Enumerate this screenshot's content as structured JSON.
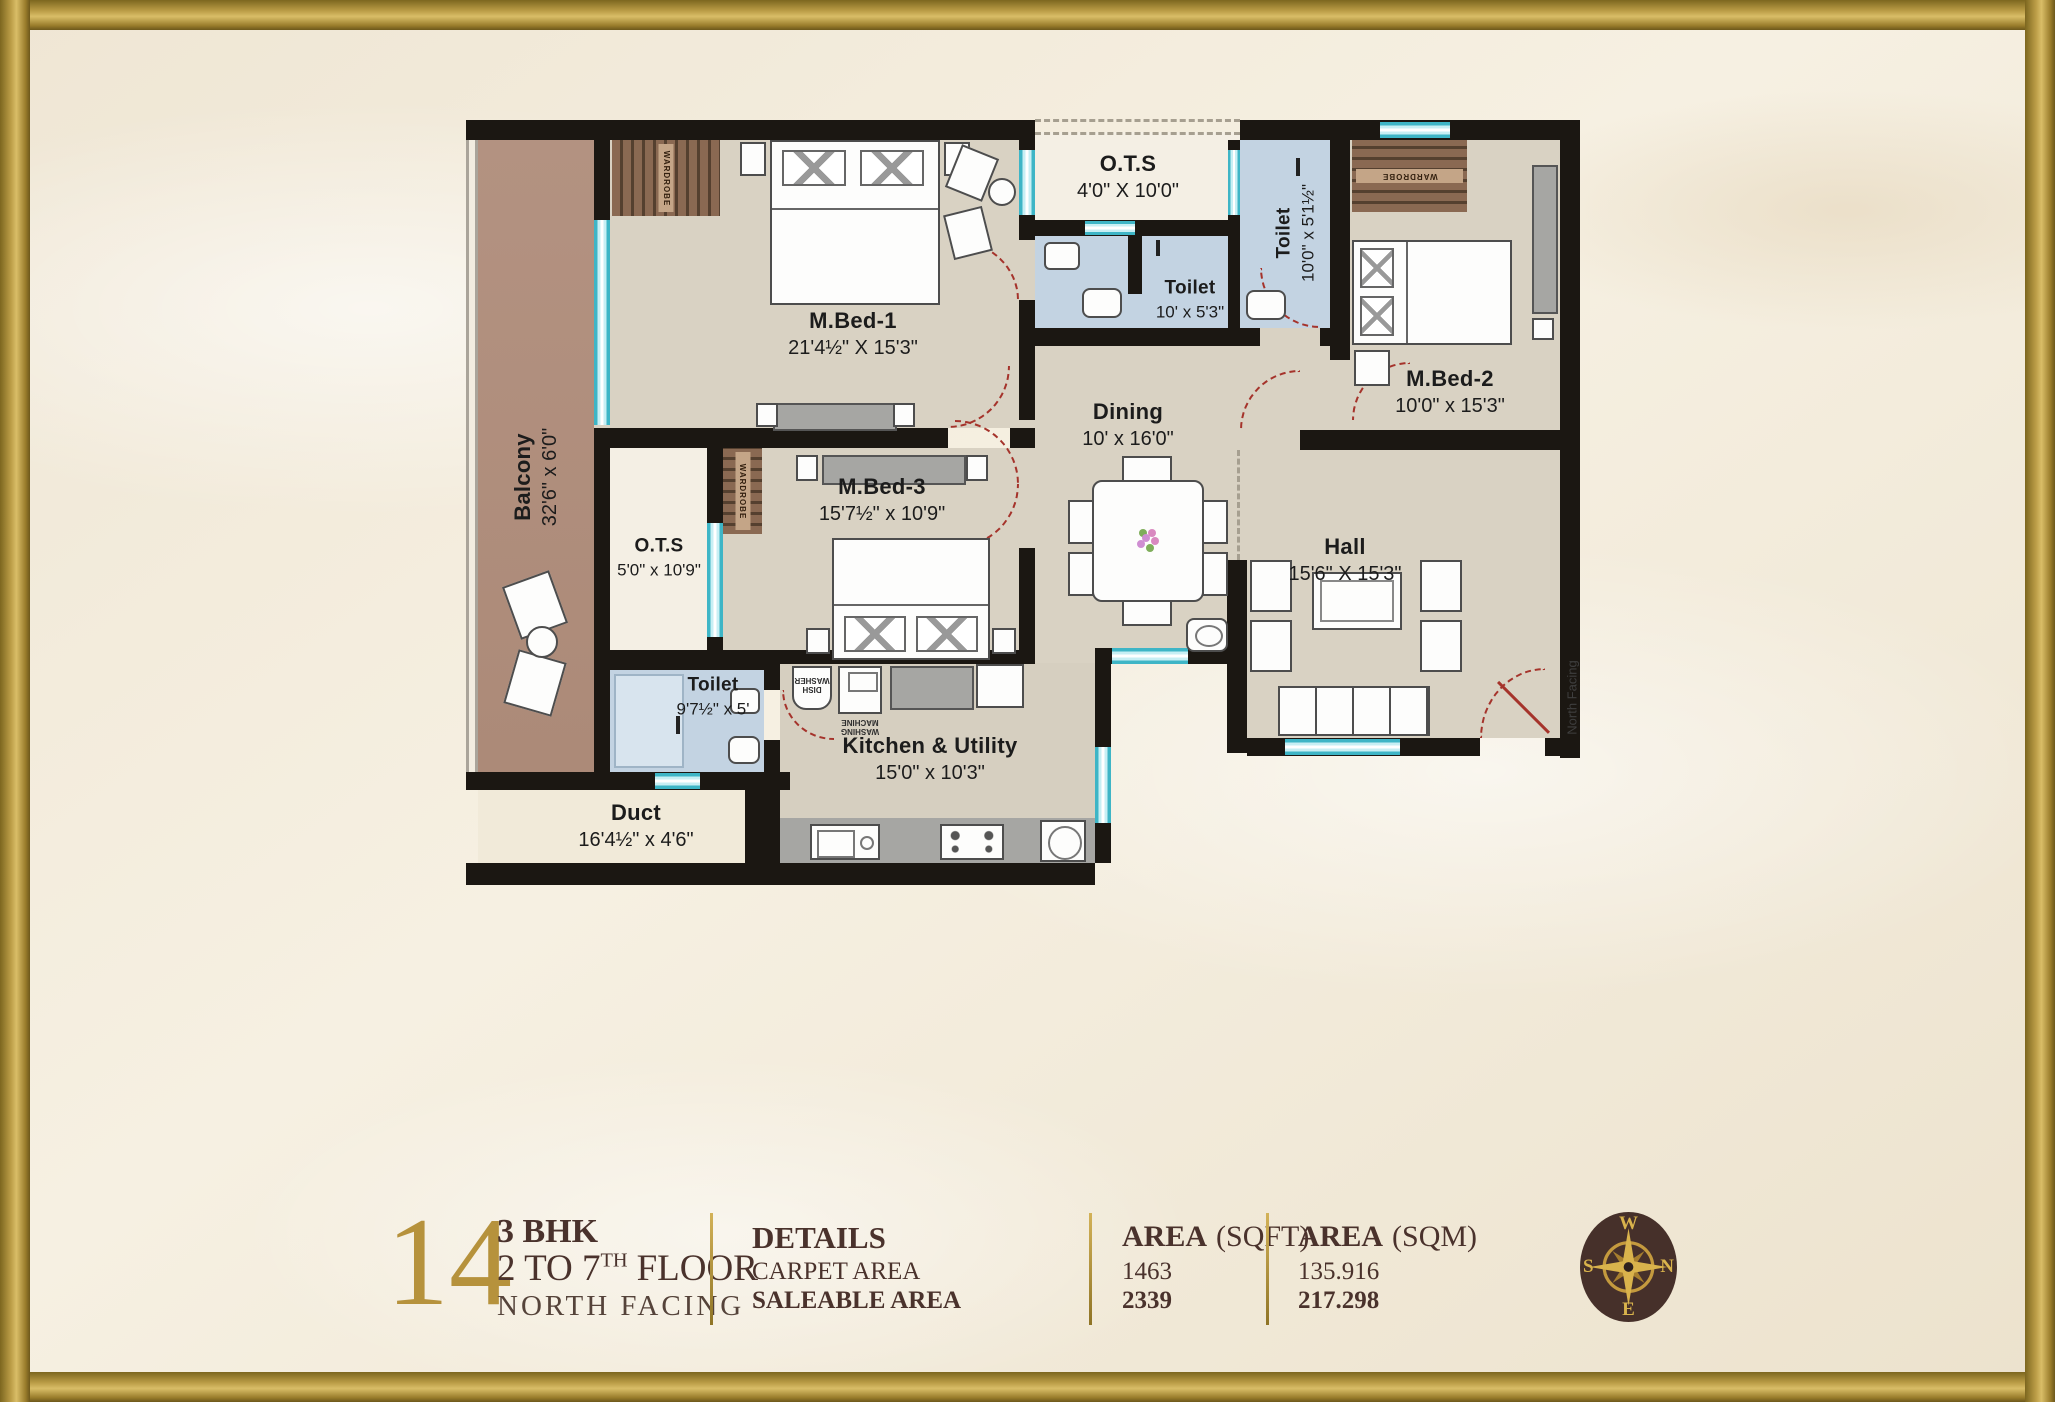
{
  "plan": {
    "rooms": {
      "balcony": {
        "name": "Balcony",
        "dim": "32'6\" x 6'0\""
      },
      "mbed1": {
        "name": "M.Bed-1",
        "dim": "21'4½\" X 15'3\""
      },
      "ots_top": {
        "name": "O.T.S",
        "dim": "4'0\" X 10'0\""
      },
      "toilet_top": {
        "name": "Toilet",
        "dim": "10' x 5'3\""
      },
      "toilet_right": {
        "name": "Toilet",
        "dim": "10'0\" x 5'1½\""
      },
      "mbed2": {
        "name": "M.Bed-2",
        "dim": "10'0\" x 15'3\""
      },
      "dining": {
        "name": "Dining",
        "dim": "10' x 16'0\""
      },
      "mbed3": {
        "name": "M.Bed-3",
        "dim": "15'7½\" x 10'9\""
      },
      "ots_left": {
        "name": "O.T.S",
        "dim": "5'0\" x 10'9\""
      },
      "toilet_bottom": {
        "name": "Toilet",
        "dim": "9'7½\" x 5'"
      },
      "kitchen": {
        "name": "Kitchen & Utility",
        "dim": "15'0\" x 10'3\""
      },
      "duct": {
        "name": "Duct",
        "dim": "16'4½\" x 4'6\""
      },
      "hall": {
        "name": "Hall",
        "dim": "15'6\" X 15'3\""
      }
    },
    "annotations": {
      "wardrobe": "WARDROBE",
      "washing_machine": "WASHING\nMACHINE",
      "dish_washer": "DISH\nWASHER",
      "north_facing": "North Facing"
    }
  },
  "info_bar": {
    "unit_number": "14",
    "unit_type": "3 BHK",
    "floor_prefix": "2 TO 7",
    "floor_sup": "TH",
    "floor_suffix": "FLOOR",
    "facing": "NORTH FACING",
    "details_title": "DETAILS",
    "carpet_label": "CARPET AREA",
    "saleable_label": "SALEABLE AREA",
    "sqft_title": "AREA",
    "sqft_unit": "(SQFT)",
    "sqft_carpet": "1463",
    "sqft_saleable": "2339",
    "sqm_title": "AREA",
    "sqm_unit": "(SQM)",
    "sqm_carpet": "135.916",
    "sqm_saleable": "217.298"
  },
  "compass": {
    "top": "W",
    "right": "N",
    "bottom": "E",
    "left": "S"
  },
  "colors": {
    "gold": "#b6923c",
    "wall": "#1b1712",
    "window_cyan": "#54c3d4",
    "door_red": "#a5332b",
    "toilet_blue": "#c3d3e2",
    "balcony_brown": "#b19080",
    "room_taupe": "#d9d2c3",
    "ots_white": "#f4efe4",
    "text_brown": "#4a322c",
    "compass_bg": "#46302a"
  }
}
